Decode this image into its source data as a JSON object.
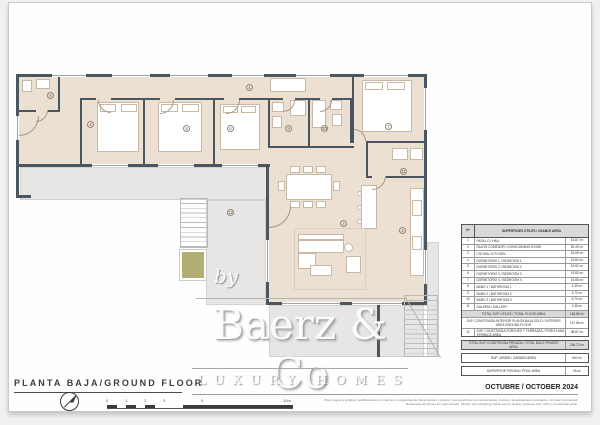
{
  "document": {
    "floor_title": "PLANTA BAJA/GROUND FLOOR",
    "date": "OCTUBRE / OCTOBER 2024",
    "disclaimer": {
      "line1": "Plano sujeto a posibles modificaciones por razones o exigencias de índole técnico y jurídico. Las superficies son aproximadas. Cocina y amueblamiento orientativo, sin valor contractual.",
      "line2": "Measurements shown are approximate. Kitchen and furnishing shown are for display purposes only, with no contractual value."
    }
  },
  "logo": {
    "by": "by",
    "name": "Baerz & Co",
    "tagline": "LUXURY HOMES"
  },
  "scale_bar": {
    "labels": [
      "0",
      "1",
      "2",
      "3",
      "5",
      "10m"
    ]
  },
  "colors": {
    "wall": "#4a5660",
    "room_fill": "#ece0d3",
    "terrace_fill": "#e7e6e4",
    "planter_green": "#b2af72",
    "table_shade": "#d9d9d9"
  },
  "plan": {
    "room_markers": [
      {
        "n": "1",
        "x": 246,
        "y": 84
      },
      {
        "n": "2",
        "x": 340,
        "y": 220
      },
      {
        "n": "3",
        "x": 399,
        "y": 227
      },
      {
        "n": "4",
        "x": 87,
        "y": 121
      },
      {
        "n": "5",
        "x": 183,
        "y": 125
      },
      {
        "n": "6",
        "x": 227,
        "y": 125
      },
      {
        "n": "7",
        "x": 385,
        "y": 123
      },
      {
        "n": "8",
        "x": 47,
        "y": 92
      },
      {
        "n": "9",
        "x": 285,
        "y": 125
      },
      {
        "n": "10",
        "x": 321,
        "y": 125
      },
      {
        "n": "11",
        "x": 400,
        "y": 168
      },
      {
        "n": "12",
        "x": 227,
        "y": 209
      }
    ]
  },
  "area_table": {
    "header": {
      "num": "Nº",
      "title": "SUPERFICIES ÚTILES / USABLE AREA"
    },
    "rows": [
      {
        "num": "1",
        "label": "PASILLO / HALL",
        "value": "18.87 m²"
      },
      {
        "num": "2",
        "label": "SALÓN COMEDOR / LIVING-DINING ROOM",
        "value": "52.49 m²"
      },
      {
        "num": "3",
        "label": "COCINA / KITCHEN",
        "value": "15.06 m²"
      },
      {
        "num": "4",
        "label": "DORMITORIO 1 / BEDROOM 1",
        "value": "13.84 m²"
      },
      {
        "num": "5",
        "label": "DORMITORIO 2 / BEDROOM 2",
        "value": "15.82 m²"
      },
      {
        "num": "6",
        "label": "DORMITORIO 3 / BEDROOM 3",
        "value": "15.82 m²"
      },
      {
        "num": "7",
        "label": "DORMITORIO 4 / BEDROOM 4",
        "value": "15.85 m²"
      },
      {
        "num": "8",
        "label": "BAÑO 1 / BATHROOM 1",
        "value": "4.35 m²"
      },
      {
        "num": "9",
        "label": "BAÑO 2 / BATHROOM 2",
        "value": "6.70 m²"
      },
      {
        "num": "10",
        "label": "BAÑO 3 / BATHROOM 3",
        "value": "6.70 m²"
      },
      {
        "num": "11",
        "label": "GALERÍA / GALLERY",
        "value": "3.35 m²"
      }
    ],
    "total_usable": {
      "label": "TOTAL SUP. ÚTILES / TOTAL FLOOR AREA",
      "value": "168.85 m²"
    },
    "built_interior": {
      "label": "SUP. CONSTRUIDA INTERIOR PLANTA BAJA SOLO / INTERIOR AREA GROUND FLOOR",
      "value": "197.85 m²"
    },
    "porches": {
      "num": "12",
      "label": "SUP. CONSTRUIDA PORCHES Y TERRAZAS / PORCH AND TERRACE AREA",
      "value": "38.87 m²"
    },
    "total_built": {
      "label": "TOTAL SUP. CONSTRUIDA PRIVADA / TOTAL BUILT PRIVATE AREA",
      "value": "236.72 m²"
    },
    "garden": {
      "label": "SUP. JARDÍN / GARDEN AREA",
      "value": "540 m²"
    },
    "pool": {
      "label": "SUPERFICIE PISCINA / POOL AREA",
      "value": "28 m²"
    }
  }
}
